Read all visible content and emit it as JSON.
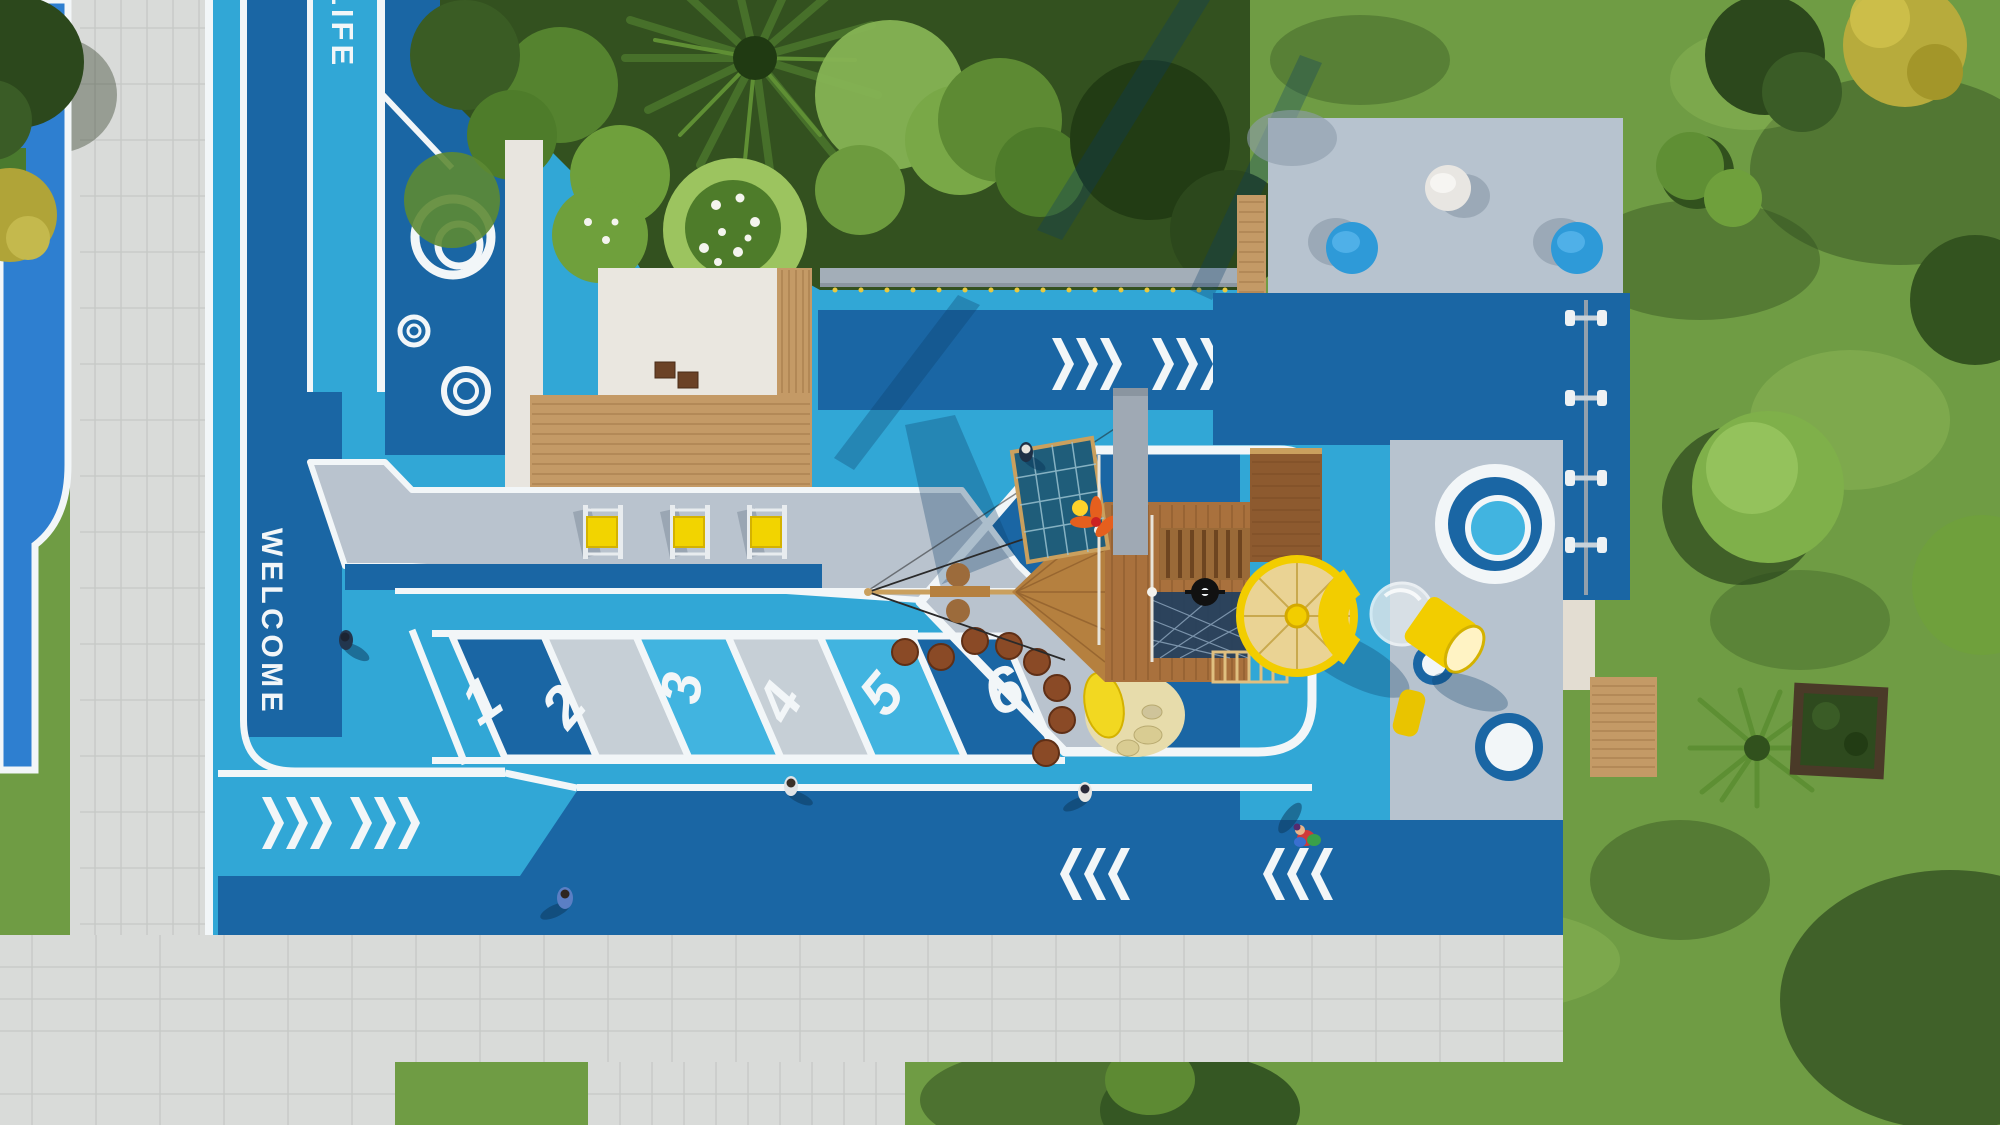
{
  "markings": {
    "lane_word_top": "LIFE",
    "welcome": "WELCOME",
    "hopscotch_cells": [
      {
        "label": "1",
        "color": "#1a66a4"
      },
      {
        "label": "2",
        "color": "#c6cfd6"
      },
      {
        "label": "3",
        "color": "#41b4e0"
      },
      {
        "label": "4",
        "color": "#c6cfd6"
      },
      {
        "label": "5",
        "color": "#41b4e0"
      },
      {
        "label": "6",
        "color": "#1a66a4"
      }
    ],
    "chevron_groups": {
      "pointing_right": 4,
      "pointing_left": 2
    }
  },
  "palette": {
    "cyan_field": "#31a7d6",
    "cyan_bright": "#41b4e0",
    "dark_blue": "#1a66a4",
    "azure_court": "#2e7fd0",
    "line_white": "#f2f6f8",
    "path_gray": "#d9dbd9",
    "bench_band_gray": "#b9c3ce",
    "platform_gray": "#b7c3cf",
    "wall_gray": "#a3aeb8",
    "stone_white": "#eae7e0",
    "deck_wood": "#c49a66",
    "ship_wood": "#a9713d",
    "ship_wood_dark": "#8d5a2f",
    "slide_yellow": "#f2cd00",
    "cone_tan": "#ead394",
    "sand": "#e7dcab",
    "stepper_brown": "#8a4a26",
    "grass": "#6f9c44",
    "grass_dark": "#2c481c",
    "grass_light": "#9cc45f",
    "seat_blue": "#2e9ad8",
    "propeller_orange": "#e55f1e"
  },
  "icons": {
    "chevron-right-marking": "›››",
    "chevron-left-marking": "‹‹‹",
    "ring-target-marking": "◎",
    "flower-stepper": "✿",
    "round-seat": "●"
  }
}
